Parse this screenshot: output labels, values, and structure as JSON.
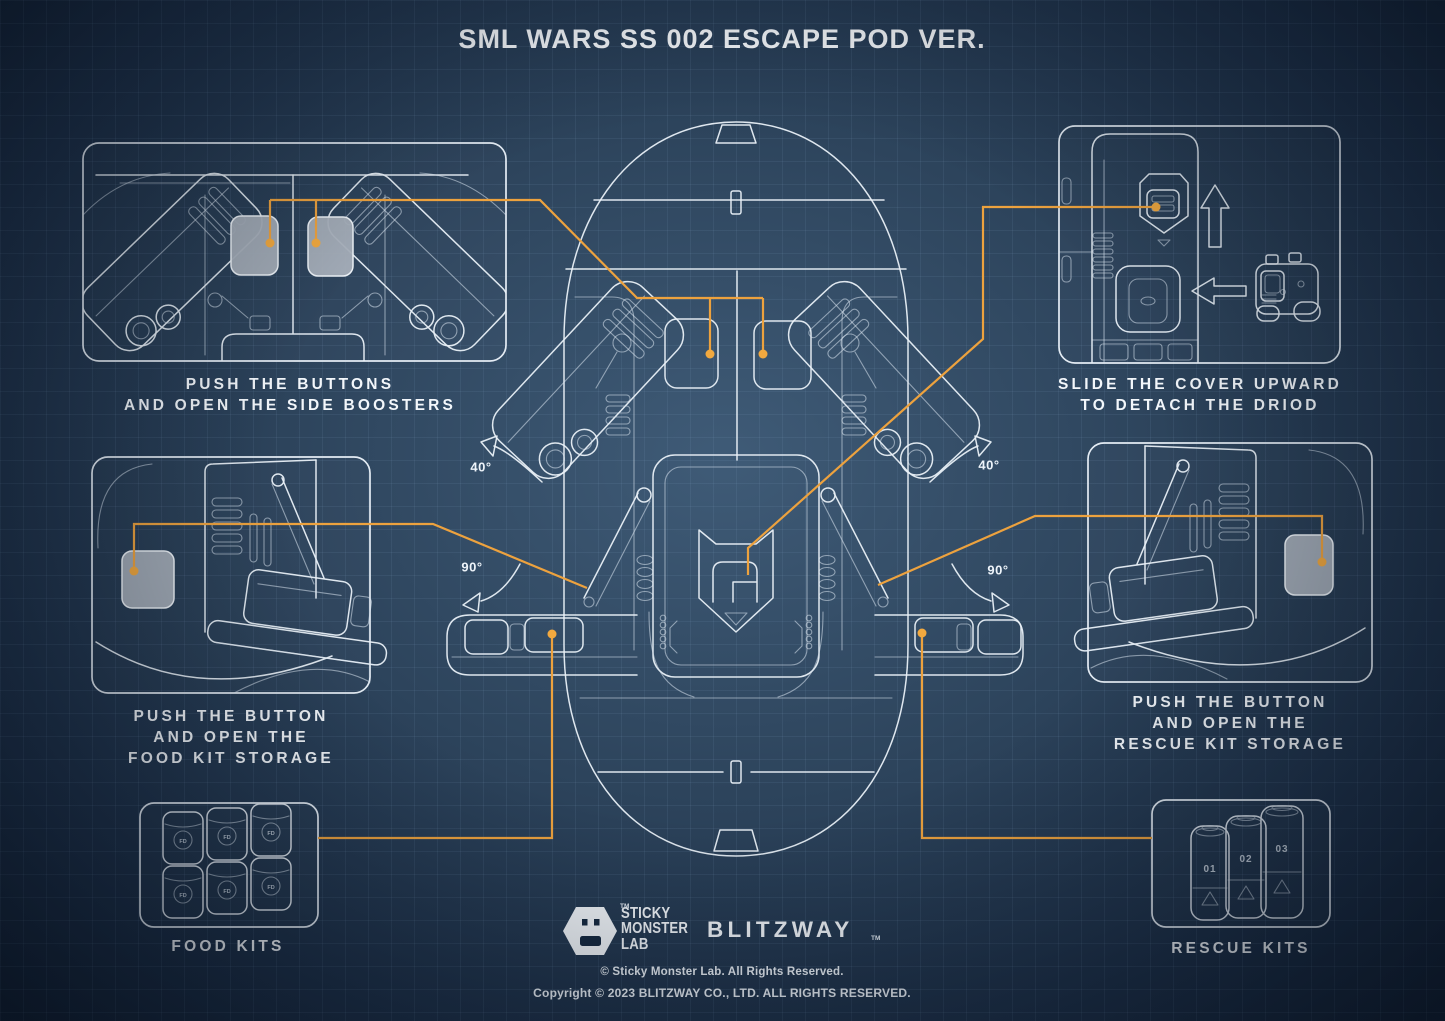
{
  "title": "SML WARS SS 002 ESCAPE POD VER.",
  "callouts": {
    "side_boosters": {
      "line1": "PUSH THE BUTTONS",
      "line2": "AND OPEN THE SIDE BOOSTERS"
    },
    "droid": {
      "line1": "SLIDE THE COVER UPWARD",
      "line2": "TO DETACH THE DRIOD"
    },
    "food_storage": {
      "line1": "PUSH THE BUTTON",
      "line2": "AND OPEN THE",
      "line3": "FOOD KIT STORAGE"
    },
    "rescue_storage": {
      "line1": "PUSH THE BUTTON",
      "line2": "AND OPEN THE",
      "line3": "RESCUE KIT STORAGE"
    },
    "food_kits": {
      "label": "FOOD KITS"
    },
    "rescue_kits": {
      "label": "RESCUE KITS"
    }
  },
  "angles": {
    "left_40": "40°",
    "right_40": "40°",
    "left_90": "90°",
    "right_90": "90°"
  },
  "kit_markings": {
    "food": "FD",
    "rescue_1": "01",
    "rescue_2": "02",
    "rescue_3": "03"
  },
  "branding": {
    "sml": {
      "line1": "STICKY",
      "line2": "MONSTER",
      "line3": "LAB",
      "tm": "TM"
    },
    "blitzway": {
      "name": "BLITZWAY",
      "tm": "TM"
    },
    "copyright1": "© Sticky Monster Lab. All Rights Reserved.",
    "copyright2": "Copyright © 2023 BLITZWAY CO., LTD. ALL RIGHTS RESERVED."
  },
  "colors": {
    "accent_orange": "#EDA23E",
    "line_art": "#E9F0F7",
    "button_gray": "#A8B0BA",
    "background_center": "#3F5B77",
    "background_edge": "#101F33"
  }
}
